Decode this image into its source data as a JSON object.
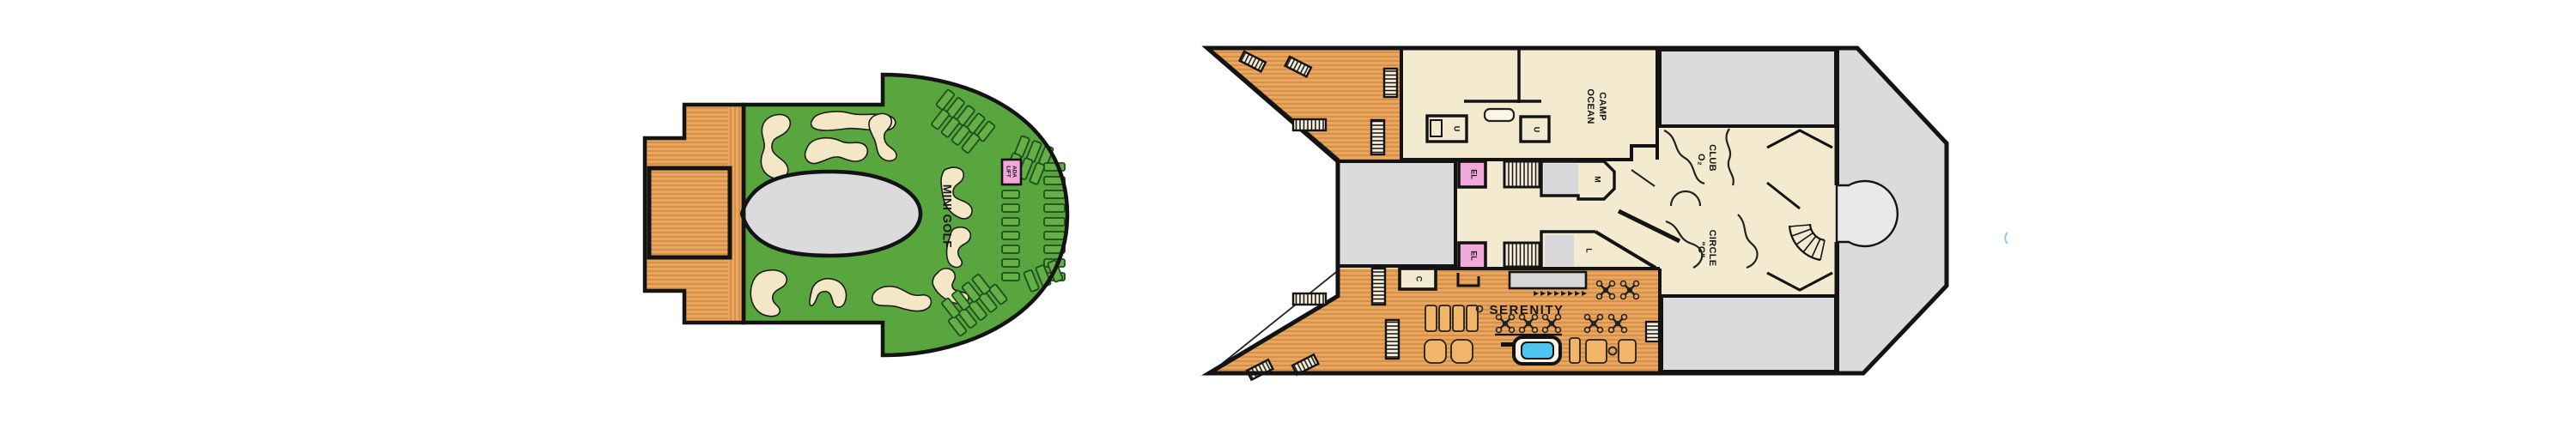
{
  "page": {
    "background": "#ffffff",
    "description_labels_total": 14
  },
  "colors": {
    "wood": "#E9A65C",
    "wood_line": "#C2813E",
    "golf_green": "#58A63D",
    "golf_blob": "#F3E7C5",
    "interior_beige": "#F3EAD0",
    "deck_gray": "#DBDBDD",
    "slab_gray": "#D8D8DA",
    "pink": "#F2A8DB",
    "pool_blue": "#4EC5F1",
    "outline": "#131313"
  },
  "mini_golf_deck": {
    "label": "MINI GOLF",
    "ada_lift": {
      "line1": "ADA",
      "line2": "LIFT"
    }
  },
  "main_deck": {
    "camp_ocean": {
      "line1": "CAMP",
      "line2": "OCEAN"
    },
    "club_o2": {
      "line1": "CLUB",
      "line2": "O₂"
    },
    "circle_c": {
      "line1": "CIRCLE",
      "line2": "\"C\""
    },
    "serenity_label": "SERENITY",
    "elevator_label": "EL",
    "mens_label": "M",
    "ladies_label": "L",
    "unisex_label": "U",
    "closet_label": "C"
  }
}
